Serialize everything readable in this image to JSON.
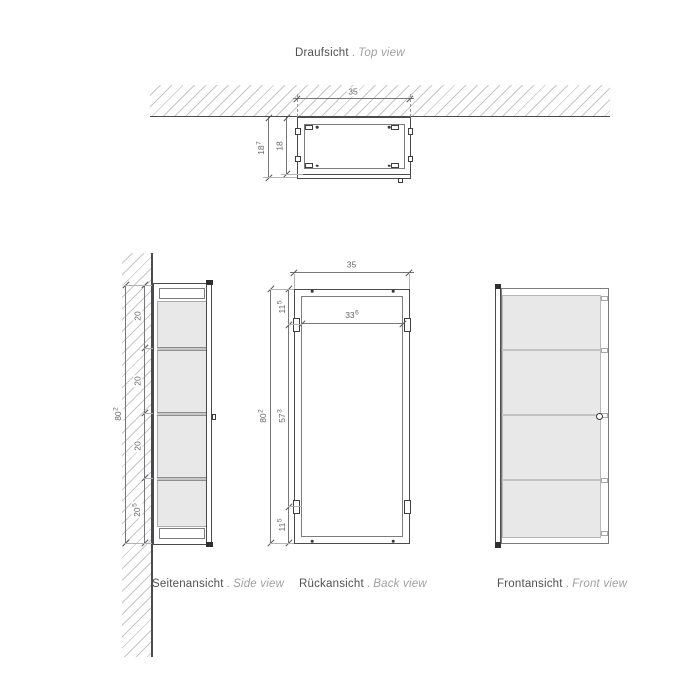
{
  "colors": {
    "background": "#ffffff",
    "outline_dark": "#4b4b4d",
    "outline_light": "#7c7c7e",
    "hatch_gray": "#c7c7c9",
    "panel_fill": "#e8e8e9",
    "shelf_fill": "#c6c6c8",
    "label_text": "#515154",
    "sublabel_text": "#a0a0a2",
    "dimension_text": "#66666a"
  },
  "top_view": {
    "title_de": "Draufsicht",
    "title_sep": ".",
    "title_en": "Top view",
    "dim_width": "35",
    "dim_depth_outer": {
      "v": "18",
      "sup": "7"
    },
    "dim_depth_inner": "18"
  },
  "side_view": {
    "label_de": "Seitenansicht",
    "label_sep": ".",
    "label_en": "Side view",
    "dim_shelf_1": "20",
    "dim_shelf_2": "20",
    "dim_shelf_3": "20",
    "dim_shelf_4": {
      "v": "20",
      "sup": "5"
    },
    "dim_height": {
      "v": "80",
      "sup": "2"
    }
  },
  "back_view": {
    "label_de": "Rückansicht",
    "label_sep": ".",
    "label_en": "Back view",
    "dim_width": "35",
    "dim_inner_width": {
      "v": "33",
      "sup": "6"
    },
    "dim_hinge_top": {
      "v": "11",
      "sup": "5"
    },
    "dim_hinge_span": {
      "v": "57",
      "sup": "3"
    },
    "dim_hinge_bottom": {
      "v": "11",
      "sup": "5"
    },
    "dim_height": {
      "v": "80",
      "sup": "2"
    }
  },
  "front_view": {
    "label_de": "Frontansicht",
    "label_sep": ".",
    "label_en": "Front view"
  }
}
